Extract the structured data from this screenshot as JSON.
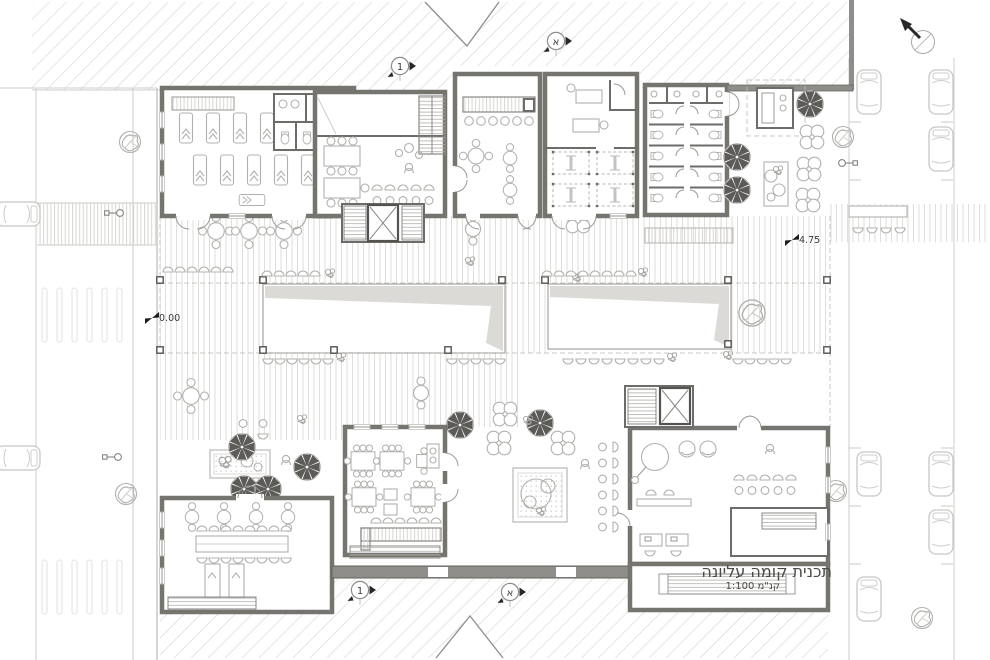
{
  "drawing": {
    "title": "תכנית קומה עליונה",
    "scale_label": "קנ\"מ 1:100",
    "elevation_markers": {
      "ground": "0.00",
      "upper_terrace": "4.75"
    },
    "section_markers": {
      "aleph": "א",
      "one": "1"
    },
    "colors": {
      "paper": "#ffffff",
      "wall_stroke": "#76746f",
      "wall_fill": "#8f8d89",
      "hatch_line": "#dcdad6",
      "deck_stripe": "#e0deda",
      "furniture_line": "#b2b0ac",
      "umbrella_fill": "#5c5b58",
      "annotation_text": "#3a3937"
    }
  }
}
